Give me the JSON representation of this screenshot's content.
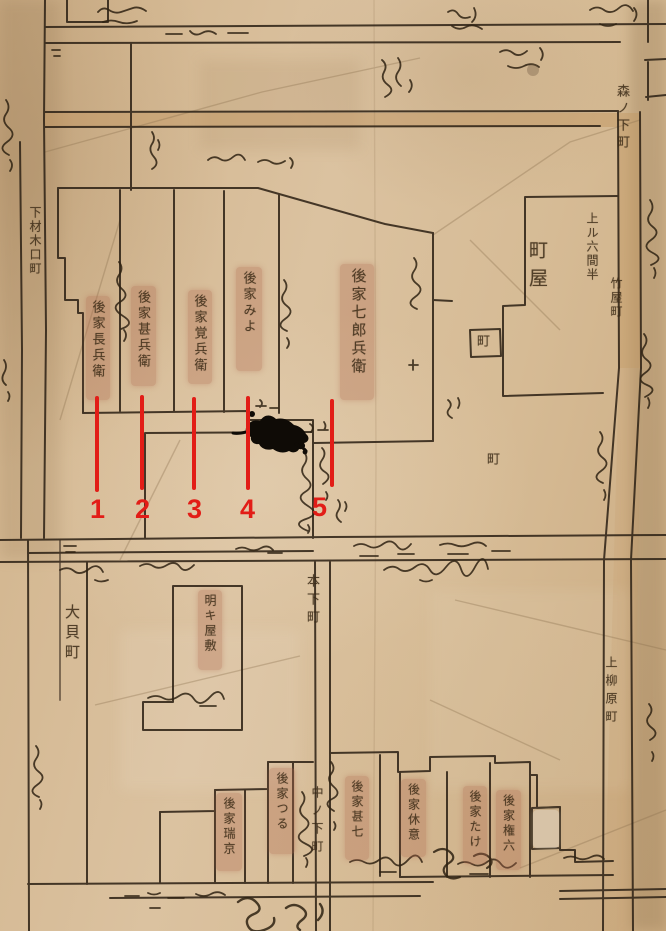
{
  "map": {
    "colors": {
      "parchment": "#d4b892",
      "ink": "#33271a",
      "road_shading": "#c2955f",
      "parcel_highlight": "#b06a50",
      "annotation_red": "#e21d17",
      "ink_blot": "#0f0b06"
    },
    "place_labels": [
      {
        "id": "shimo-guchi-machi",
        "text": "下材木口町"
      },
      {
        "id": "ogai-machi",
        "text": "大貝町"
      },
      {
        "id": "mori-no-shita-machi",
        "text": "森ノ下町"
      },
      {
        "id": "agaru-rokkenhan",
        "text": "上ル六間半"
      },
      {
        "id": "takeya-machi",
        "text": "竹屋町"
      },
      {
        "id": "machiya",
        "text": "町屋"
      },
      {
        "id": "machi-upper",
        "text": "町"
      },
      {
        "id": "machi-lower",
        "text": "町"
      },
      {
        "id": "moto-shita-machi",
        "text": "本下町"
      },
      {
        "id": "naka-no-shita-machi",
        "text": "中ノ下町"
      },
      {
        "id": "kami-yanagiwara-machi",
        "text": "上柳原町"
      }
    ],
    "parcels_upper": [
      {
        "marker": "1",
        "label": "後家長兵衛"
      },
      {
        "marker": "2",
        "label": "後家甚兵衛"
      },
      {
        "marker": "3",
        "label": "後家覚兵衛"
      },
      {
        "marker": "4",
        "label": "後家みよ"
      },
      {
        "marker": "5",
        "label": "後家七郎兵衛"
      }
    ],
    "parcels_lower": [
      {
        "label": "後家瑞京"
      },
      {
        "label": "後家つる"
      },
      {
        "label": "後家甚七"
      },
      {
        "label": "後家休意"
      },
      {
        "label": "後家たけ"
      },
      {
        "label": "後家権六"
      }
    ],
    "vacant_parcel": {
      "label": "明キ屋敷"
    },
    "markers": {
      "color": "#e21d17",
      "items": [
        {
          "number": "1"
        },
        {
          "number": "2"
        },
        {
          "number": "3"
        },
        {
          "number": "4"
        },
        {
          "number": "5"
        }
      ]
    }
  }
}
